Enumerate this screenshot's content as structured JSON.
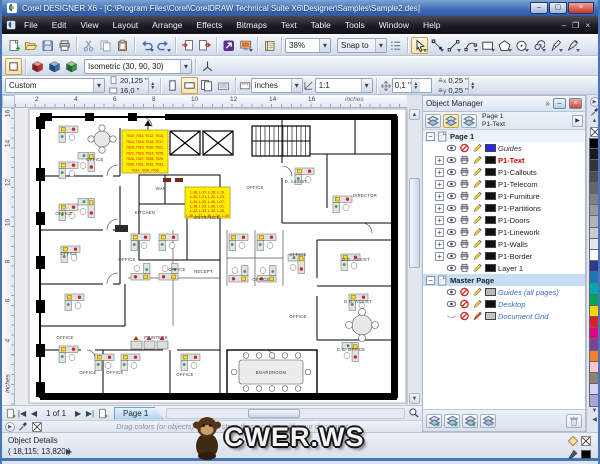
{
  "window": {
    "title": "Corel DESIGNER X6 - [C:\\Program Files\\Corel\\CorelDRAW Technical Suite X6\\Designer\\Samples\\Sample2.des]",
    "buttons": [
      "minimize",
      "maximize",
      "close"
    ]
  },
  "menu": {
    "items": [
      "File",
      "Edit",
      "View",
      "Layout",
      "Arrange",
      "Effects",
      "Bitmaps",
      "Text",
      "Table",
      "Tools",
      "Window",
      "Help"
    ],
    "doc_buttons": [
      "doc-minimize",
      "doc-restore",
      "doc-close"
    ]
  },
  "toolbar": {
    "std_icons": [
      "new",
      "open",
      "save",
      "print",
      "cut",
      "copy",
      "paste",
      "undo",
      "redo",
      "import",
      "export",
      "app-launcher",
      "welcome-screen",
      "corel-guide"
    ],
    "zoom_value": "38%",
    "snap_label": "Snap to",
    "options_icon": "options",
    "tools": [
      "pick",
      "shape",
      "line",
      "bezier",
      "rectangle",
      "polygon",
      "ellipse",
      "spiral",
      "pen",
      "curve-pen"
    ]
  },
  "projection_bar": {
    "icons": [
      "no-projection",
      "cube-red",
      "cube-blue",
      "cube-green"
    ],
    "preset": "Isometric (30, 90, 30)",
    "axes_icon": "axes"
  },
  "property_bar": {
    "preset": "Custom",
    "page_width": "20,125 \"",
    "page_height": "16,0 \"",
    "units": "inches",
    "scale": "1:1",
    "nudge": "0,1 \"",
    "dup_x": "0,25 \"",
    "dup_y": "0,25 \""
  },
  "rulers": {
    "h_ticks": [
      "2",
      "4",
      "6",
      "8",
      "10",
      "12",
      "14",
      "16"
    ],
    "unit": "inches",
    "v_ticks": [
      "16",
      "14",
      "12",
      "10",
      "8",
      "6",
      "4"
    ]
  },
  "docker": {
    "title": "Object Manager",
    "chevron": "»",
    "active_page": "Page 1",
    "active_layer": "P1-Text",
    "header_buttons": [
      "show-object-properties",
      "edit-across-layers",
      "layer-manager-view"
    ],
    "tree": [
      {
        "label": "Page 1",
        "kind": "page",
        "current": true
      },
      {
        "label": "Guides",
        "kind": "layer",
        "expand": false,
        "eye": true,
        "print": false,
        "pencil": true,
        "swatch": "#2a2ae0",
        "italic": true,
        "color": "#333333"
      },
      {
        "label": "P1-Text",
        "kind": "layer",
        "expand": true,
        "eye": true,
        "print": true,
        "pencil": true,
        "swatch": "#111111",
        "bold": true,
        "color": "#cc0000"
      },
      {
        "label": "P1-Callouts",
        "kind": "layer",
        "expand": true,
        "eye": true,
        "print": true,
        "pencil": true,
        "swatch": "#111111",
        "color": "#222222"
      },
      {
        "label": "P1-Telecom",
        "kind": "layer",
        "expand": true,
        "eye": true,
        "print": true,
        "pencil": true,
        "swatch": "#111111",
        "color": "#222222"
      },
      {
        "label": "P1-Furniture",
        "kind": "layer",
        "expand": true,
        "eye": true,
        "print": true,
        "pencil": true,
        "swatch": "#111111",
        "color": "#222222"
      },
      {
        "label": "P1-Partitions",
        "kind": "layer",
        "expand": true,
        "eye": true,
        "print": true,
        "pencil": true,
        "swatch": "#111111",
        "color": "#222222"
      },
      {
        "label": "P1-Doors",
        "kind": "layer",
        "expand": true,
        "eye": true,
        "print": true,
        "pencil": true,
        "swatch": "#111111",
        "color": "#222222"
      },
      {
        "label": "P1-Linework",
        "kind": "layer",
        "expand": true,
        "eye": true,
        "print": true,
        "pencil": true,
        "swatch": "#111111",
        "color": "#222222"
      },
      {
        "label": "P1-Walls",
        "kind": "layer",
        "expand": true,
        "eye": true,
        "print": true,
        "pencil": true,
        "swatch": "#111111",
        "color": "#222222"
      },
      {
        "label": "P1-Border",
        "kind": "layer",
        "expand": true,
        "eye": true,
        "print": true,
        "pencil": true,
        "swatch": "#111111",
        "color": "#222222"
      },
      {
        "label": "Layer 1",
        "kind": "layer",
        "expand": false,
        "eye": true,
        "print": true,
        "pencil": true,
        "swatch": "#111111",
        "color": "#222222"
      },
      {
        "label": "Master Page",
        "kind": "page",
        "selected": true
      },
      {
        "label": "Guides (all pages)",
        "kind": "layer",
        "expand": false,
        "eye": true,
        "print": false,
        "pencil": true,
        "swatch": "#b8b8b8",
        "italic": true,
        "color": "#3b6ccc"
      },
      {
        "label": "Desktop",
        "kind": "layer",
        "expand": false,
        "eye": true,
        "print": false,
        "pencil": true,
        "swatch": "#111111",
        "italic": true,
        "color": "#3b6ccc"
      },
      {
        "label": "Document Grid",
        "kind": "layer",
        "expand": false,
        "eye": "dim",
        "print": false,
        "pencil": false,
        "swatch": "#c4c4c4",
        "italic": true,
        "color": "#3b6ccc"
      }
    ],
    "bottom_buttons": [
      "new-layer",
      "new-master-layer",
      "new-master-layer-odd",
      "new-master-layer-even"
    ],
    "trash_icon": "trash"
  },
  "palette": {
    "colors": [
      "#000000",
      "#1a1a1a",
      "#333333",
      "#4d4d4d",
      "#666666",
      "#808080",
      "#999999",
      "#b3b3b3",
      "#cccccc",
      "#e6e6e6",
      "#ffffff",
      "#2b3990",
      "#1b75bc",
      "#00a7b5",
      "#00a651",
      "#ffd400",
      "#da2128",
      "#e6007e",
      "#7d4199",
      "#f58220",
      "#fbc5d2",
      "#8a8474",
      "#d8d3ec",
      "#aaa4d8"
    ]
  },
  "pagebar": {
    "page_indicator": "1 of 1",
    "tab_label": "Page 1"
  },
  "document_palette": {
    "hint": "Drag colors (or objects) here to store these colors with your document"
  },
  "status": {
    "label": "Object Details",
    "coords": "( 18,115; 13,820 )"
  },
  "watermark": {
    "text": "CWER.WS"
  },
  "floorplan": {
    "labels": [
      {
        "t": "OFFICE",
        "x": 80,
        "y": 53
      },
      {
        "t": "OFFICE",
        "x": 49,
        "y": 107
      },
      {
        "t": "OFFICE",
        "x": 54,
        "y": 147
      },
      {
        "t": "OFFICE",
        "x": 112,
        "y": 153
      },
      {
        "t": "OFFICE",
        "x": 162,
        "y": 163
      },
      {
        "t": "RECEPT.",
        "x": 189,
        "y": 165
      },
      {
        "t": "OFFICE",
        "x": 240,
        "y": 81
      },
      {
        "t": "D. ASSIST",
        "x": 281,
        "y": 75
      },
      {
        "t": "DIRECTOR",
        "x": 350,
        "y": 89
      },
      {
        "t": "WAN",
        "x": 146,
        "y": 82
      },
      {
        "t": "KITCHEN",
        "x": 130,
        "y": 106
      },
      {
        "t": "ENTRANCE",
        "x": 192,
        "y": 111
      },
      {
        "t": "OFFICE",
        "x": 283,
        "y": 148
      },
      {
        "t": "D.G. ASSIST",
        "x": 341,
        "y": 153
      },
      {
        "t": "OFFICE",
        "x": 246,
        "y": 173
      },
      {
        "t": "D.G. ASSIST",
        "x": 343,
        "y": 195
      },
      {
        "t": "OFFICE",
        "x": 283,
        "y": 210
      },
      {
        "t": "OFFICE",
        "x": 50,
        "y": 231
      },
      {
        "t": "PRINTERS",
        "x": 141,
        "y": 231
      },
      {
        "t": "OFFICE",
        "x": 73,
        "y": 266
      },
      {
        "t": "OFFICE",
        "x": 100,
        "y": 266
      },
      {
        "t": "OFFICE",
        "x": 170,
        "y": 268
      },
      {
        "t": "D.G. OFFICE",
        "x": 336,
        "y": 243
      },
      {
        "t": "BOARDROOM",
        "x": 256,
        "y": 266
      }
    ],
    "callout1": {
      "x": 107,
      "y": 22,
      "w": 46,
      "h": 43,
      "lines": [
        "7010, 7011, 7012, 7013,",
        "7014, 7015, 7016, 7017,",
        "7018, 7019, 7020, 7021,",
        "7022, 7023, 7024, 7025,",
        "7026, 7027, 7028, 7029,",
        "7030, 7031, 7032, 7033,",
        "7034, 7035, 7036"
      ]
    },
    "callout2": {
      "x": 170,
      "y": 79,
      "w": 45,
      "h": 31,
      "lines": [
        "L-16, L-17, L-18, L-19,",
        "L-20, L-21, L-22, L-23,",
        "L-24, L-25, L-26, L-27,",
        "L-28, L-29, L-30, L-31,",
        "L-32, L-33, L-34, L-35,",
        "L-36, L-37, L-38, L-39, L-40"
      ]
    }
  }
}
